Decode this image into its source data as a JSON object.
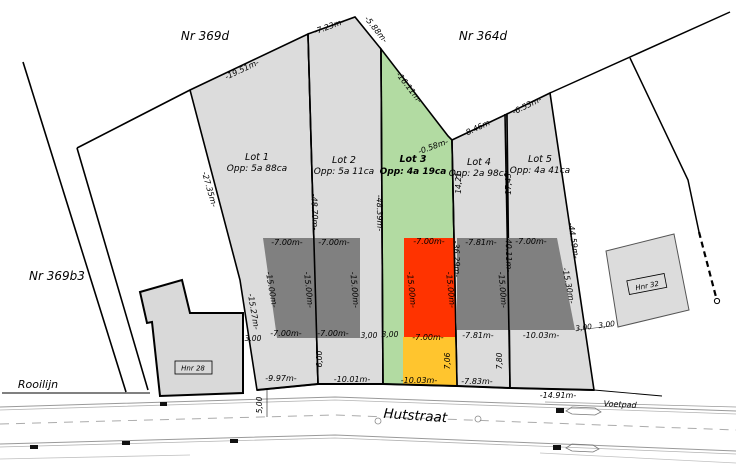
{
  "regions": {
    "nr_369d": "Nr 369d",
    "nr_364d": "Nr 364d",
    "nr_369b3": "Nr 369b3"
  },
  "street": {
    "name": "Hutstraat",
    "sidewalk": "Voetpad",
    "building_line": "Rooilijn"
  },
  "houses": {
    "left": "Hnr 28",
    "right": "Hnr 32"
  },
  "lots": [
    {
      "name": "Lot 1",
      "area": "Opp: 5a 88ca"
    },
    {
      "name": "Lot 2",
      "area": "Opp: 5a 11ca"
    },
    {
      "name": "Lot 3",
      "area": "Opp: 4a 19ca"
    },
    {
      "name": "Lot 4",
      "area": "Opp: 2a 98ca"
    },
    {
      "name": "Lot 5",
      "area": "Opp: 4a 41ca"
    }
  ],
  "dims": {
    "top_lot1": "-19.51m-",
    "top_lot2": "-7.23m-",
    "top_lot2b": "-5.88m-",
    "top_lot3": "-16.11m-",
    "notch": "-0.58m-",
    "top_lot4": "-8.46m-",
    "top_lot5": "-6.53m-",
    "left_upper": "-27.35m-",
    "left_lower": "-15.27m-",
    "b12": "-48.70m-",
    "b23": "-48.39m-",
    "b34_upper": "14,21",
    "b45_upper": "17,45",
    "b34": "-36.29m-",
    "b45": "-40.11m-",
    "right_boundary": "-44.59m-",
    "front_lot1": "-9.97m-",
    "front_lot2": "-10.01m-",
    "front_lot3": "-10.03m-",
    "front_lot4": "-7.83m-",
    "front_lot5": "-14.91m-",
    "z1_top": "-7.00m-",
    "z1_bottom": "-7.00m-",
    "z1_left": "-15.00m-",
    "z1_right": "-15.00m-",
    "z2_top": "-7.00m-",
    "z2_bottom": "-7.00m-",
    "z2_side": "-15.00m-",
    "z3_top": "-7.00m-",
    "z3_bottom": "-7.00m-",
    "z3_left": "-15.00m-",
    "z3_right": "-15.00m-",
    "z4_top": "-7.81m-",
    "z4_bottom": "-7.81m-",
    "z4_side": "-15.00m-",
    "z5_top": "-7.00m-",
    "z5_bottom": "-10.03m-",
    "z5_side": "-15.30m-",
    "setback_z1": "3,00",
    "setback_z2": "3,00",
    "setback_z3": "3,00",
    "setback_z5": "3,00",
    "setback_house32": "3,00",
    "depth_lot2": "6,00",
    "depth_lot3": "7,06",
    "depth_lot4": "7,80",
    "verge": "5,00"
  },
  "colors": {
    "parcel_gray": "#dcdcdc",
    "zone_gray": "#808080",
    "lot3_green": "#b2dba2",
    "zone_red": "#ff3300",
    "strip_yellow": "#ffc52e",
    "house_gray": "#d9d9d9"
  }
}
